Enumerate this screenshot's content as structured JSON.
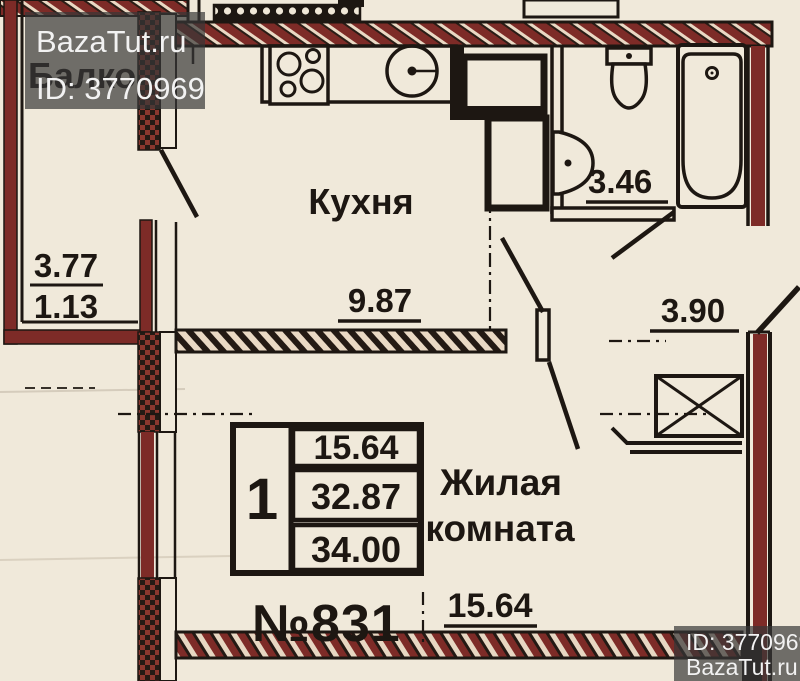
{
  "watermarks": {
    "top": {
      "brand": "BazaTut.ru",
      "listing_id": "ID: 3770969"
    },
    "bottom": {
      "listing_id": "ID: 3770969",
      "brand": "BazaTut.ru"
    }
  },
  "plan": {
    "apartment_number": "№831",
    "rooms": {
      "balcony": {
        "label": "Балкон",
        "dims": {
          "top": "3.77",
          "bottom": "1.13"
        }
      },
      "kitchen": {
        "label": "Кухня",
        "dim": "9.87"
      },
      "bathroom": {
        "dim": "3.46"
      },
      "hallway": {
        "dim": "3.90"
      },
      "living_room": {
        "label_line1": "Жилая",
        "label_line2": "комната",
        "dim": "15.64"
      }
    },
    "info_table": {
      "rooms": "1",
      "row1": "15.64",
      "row2": "32.87",
      "row3": "34.00"
    }
  },
  "colors": {
    "paper": "#f0e9da",
    "wall_maroon": "#7d2b27",
    "ink": "#1d1712",
    "watermark_bg": "rgba(55,55,55,0.7)",
    "watermark_text": "#f2f2f2"
  }
}
